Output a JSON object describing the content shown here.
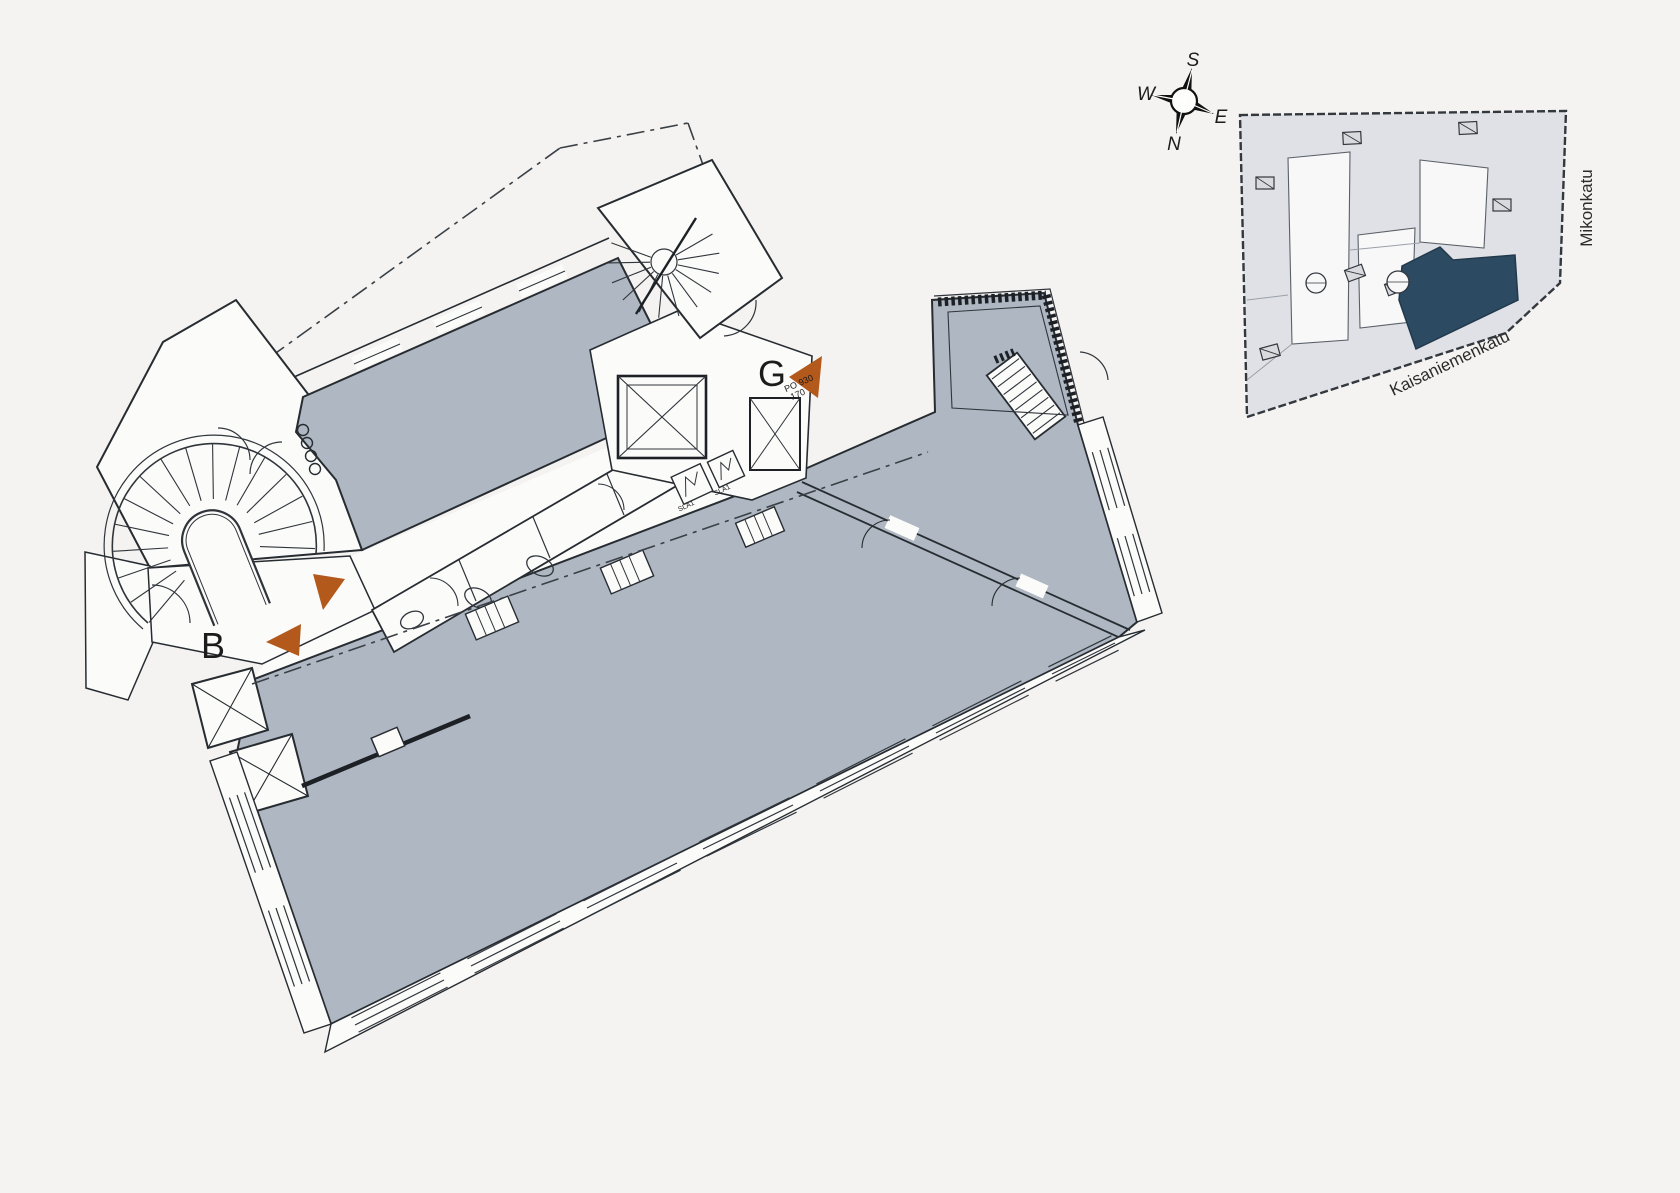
{
  "floor_plan": {
    "labels": {
      "stairwell_b": "B",
      "stairwell_g": "G"
    },
    "door_marking": {
      "line1": "PO 930",
      "line2": "170"
    },
    "shaft_labels": [
      "SLA1",
      "SLA1"
    ],
    "colors": {
      "background": "#f4f3f1",
      "floor_fill": "#aeb7c2",
      "room_fill": "#fbfbfa",
      "wall_line": "#272c31",
      "entrance_arrow": "#b3591c"
    }
  },
  "compass": {
    "north": "N",
    "south": "S",
    "east": "E",
    "west": "W"
  },
  "key_plan": {
    "street_bottom": "Kaisaniemenkatu",
    "street_right": "Mikonkatu",
    "colors": {
      "building_fill": "#e0e1e7",
      "courtyard_fill": "#f8f8f8",
      "highlight_fill": "#2c4a62",
      "outline": "#33383e"
    }
  }
}
